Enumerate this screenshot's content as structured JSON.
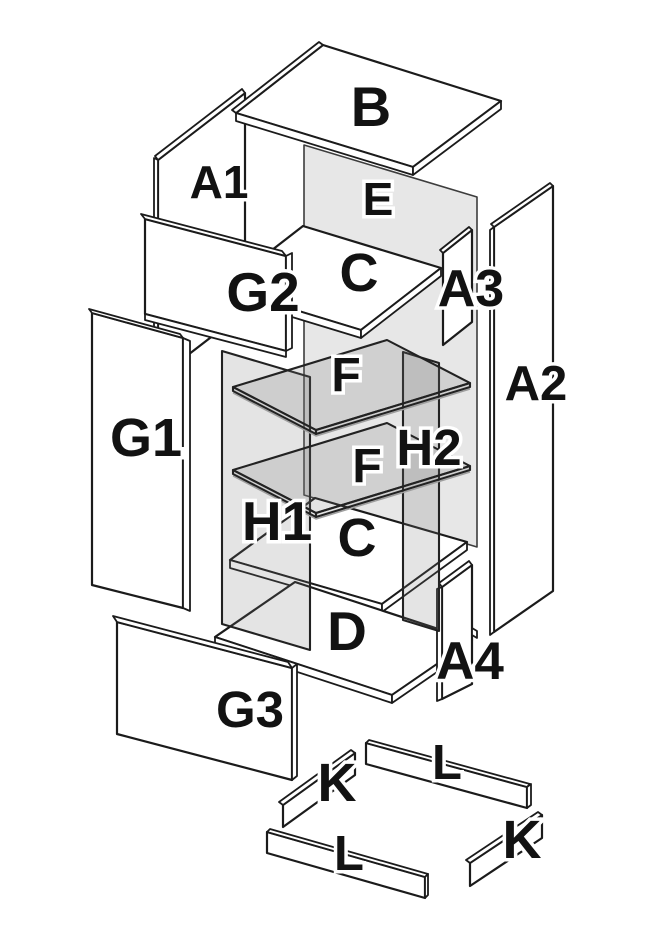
{
  "diagram": {
    "kind": "exploded-furniture-assembly-diagram",
    "colors": {
      "background": "#ffffff",
      "outline": "#1b1b1b",
      "panel_fill": "#ffffff",
      "glass_fill": "#e8e8e8",
      "label_text": "#121212",
      "label_halo": "#ffffff"
    }
  },
  "labels": [
    {
      "id": "b",
      "text": "B"
    },
    {
      "id": "a1",
      "text": "A1"
    },
    {
      "id": "e",
      "text": "E"
    },
    {
      "id": "g2",
      "text": "G2"
    },
    {
      "id": "c-top",
      "text": "C"
    },
    {
      "id": "a3",
      "text": "A3"
    },
    {
      "id": "a2",
      "text": "A2"
    },
    {
      "id": "g1",
      "text": "G1"
    },
    {
      "id": "f-top",
      "text": "F"
    },
    {
      "id": "h2",
      "text": "H2"
    },
    {
      "id": "f-bottom",
      "text": "F"
    },
    {
      "id": "h1",
      "text": "H1"
    },
    {
      "id": "c-bottom",
      "text": "C"
    },
    {
      "id": "d",
      "text": "D"
    },
    {
      "id": "a4",
      "text": "A4"
    },
    {
      "id": "g3",
      "text": "G3"
    },
    {
      "id": "k-left",
      "text": "K"
    },
    {
      "id": "l-back",
      "text": "L"
    },
    {
      "id": "l-front",
      "text": "L"
    },
    {
      "id": "k-right",
      "text": "K"
    }
  ]
}
